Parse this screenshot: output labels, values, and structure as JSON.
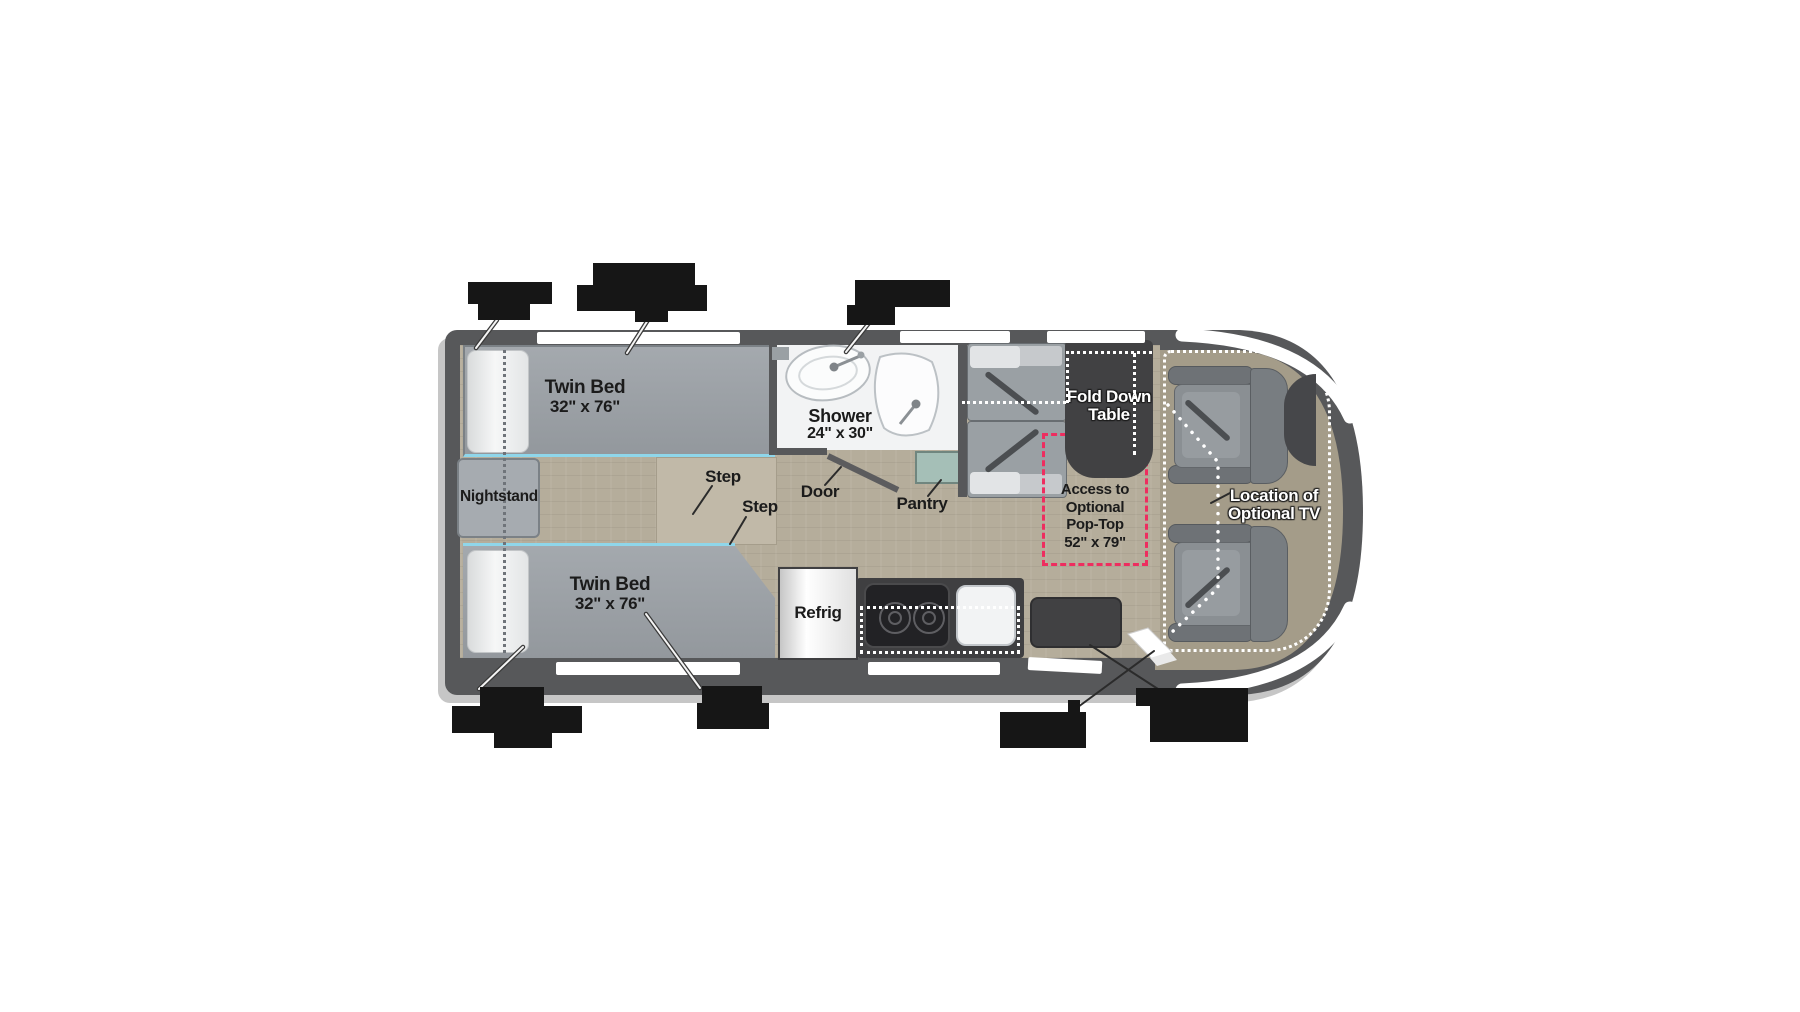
{
  "title": "Motorhome floor plan with twin beds, wet bath, galley and swivel cab seats",
  "colors": {
    "body_gray": "#57585a",
    "floor_tan": "#b5ad9b",
    "cab_floor": "#a49c89",
    "accent_pink": "#ee2d5f",
    "accent_cyan": "#8fd6ea",
    "pantry_teal": "#a5bfb7",
    "furniture_gray": "#9ba0a5",
    "dark_fixture": "#414143"
  },
  "rooms": {
    "bed_top": {
      "name": "Twin Bed",
      "size": "32\" x 76\""
    },
    "bed_bottom": {
      "name": "Twin Bed",
      "size": "32\" x 76\""
    },
    "nightstand": {
      "name": "Nightstand"
    },
    "shower": {
      "name": "Shower",
      "size": "24\" x 30\""
    },
    "step_upper": {
      "name": "Step"
    },
    "step_lower": {
      "name": "Step"
    },
    "door": {
      "name": "Door"
    },
    "pantry": {
      "name": "Pantry"
    },
    "refrig": {
      "name": "Refrig"
    },
    "fold_table": {
      "line1": "Fold Down",
      "line2": "Table"
    },
    "pop_top": {
      "line1": "Access to",
      "line2": "Optional",
      "line3": "Pop-Top",
      "line4": "52\" x 79\""
    },
    "tv": {
      "line1": "Location of",
      "line2": "Optional TV"
    }
  },
  "redacted_callouts": {
    "top": 3,
    "bottom": 4
  }
}
